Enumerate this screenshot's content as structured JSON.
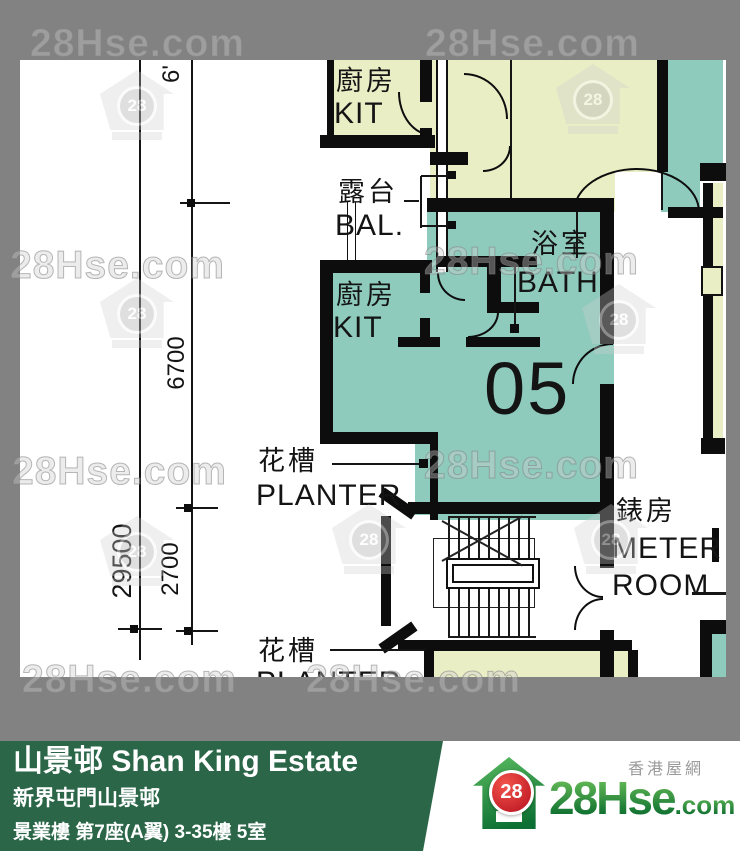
{
  "watermark": {
    "text": "28Hse.com",
    "badge": "28"
  },
  "dimensions": {
    "seg_top": "6'",
    "seg_mid": "6700",
    "seg_low": "2700",
    "total": "29500"
  },
  "rooms": {
    "kit_upper": {
      "zh": "廚房",
      "en": "KIT"
    },
    "balcony": {
      "zh": "露台",
      "en": "BAL."
    },
    "bath": {
      "zh": "浴室",
      "en": "BATH"
    },
    "kit_unit": {
      "zh": "廚房",
      "en": "KIT"
    },
    "unit_number": "05",
    "planter_upper": {
      "zh": "花槽",
      "en": "PLANTER"
    },
    "planter_lower": {
      "zh": "花槽",
      "en": "PLANTER"
    },
    "meter_room": {
      "zh": "錶房",
      "en_line1": "METER",
      "en_line2": "ROOM"
    }
  },
  "info_bar": {
    "title": "山景邨 Shan King Estate",
    "subtitle": "新界屯門山景邨",
    "block_info": "景業樓 第7座(A翼) 3-35樓 5室",
    "area_info": "381 sqf(實用面積 Saleable Area)"
  },
  "logo": {
    "tagline": "香港屋網",
    "badge": "28",
    "brand": "28Hse",
    "brand_suffix": ".com"
  },
  "colors": {
    "unit_fill": "#8ecbbd",
    "neighbor_fill": "#eaeec5",
    "bar_green": "#2a6647",
    "badge_red": "#cc1122",
    "wall_black": "#0d0d0d",
    "background_gray": "#828282"
  }
}
